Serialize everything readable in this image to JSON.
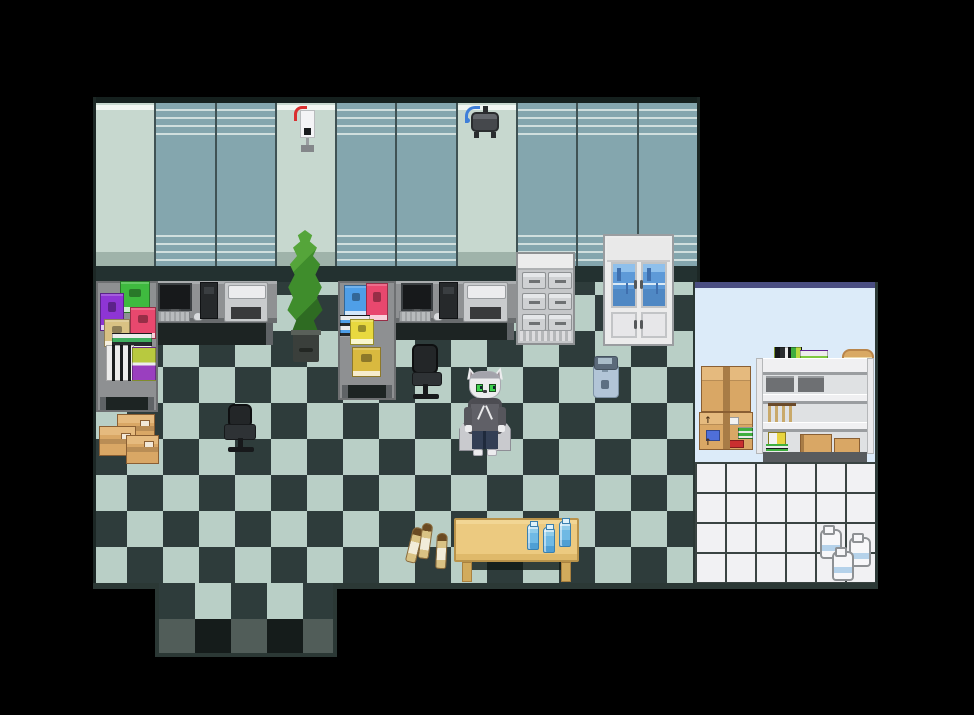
{
  "scene": {
    "label": "pixel-art office room with checkered floor, two computer workstations, storage room and white cat character in hoodie",
    "palette": {
      "bg": "#000000",
      "floorLight": "#b9cfc6",
      "floorDark": "#2e3c3b",
      "exitGray": "#515d59",
      "exitDark": "#151c1b",
      "wallTeal": "#84a6ae",
      "wallPale": "#c7d8cf",
      "wallStripe": "#dde9e6",
      "wallPaleStripe": "#f0f5f1",
      "wallPaleShade": "#9fb3aa",
      "wallDivider": "#3f5254",
      "wallBase": "#233130",
      "wallTopEdge": "#15201e",
      "storageWall": "#dcebf9",
      "storageBorderTop": "#4a4e82",
      "tileWhite": "#f1f1f3",
      "tileGrout": "#3a4442",
      "roomOutline": "#2b3835",
      "deskTop": "#8f9193",
      "deskDark": "#1d2423",
      "deskLegGray": "#5f6366",
      "cardboard": "#d9a765",
      "cardboardFlap": "#e5ba7e",
      "tape": "#a87c46",
      "tableTan": "#ecca80",
      "tableLeg": "#d2ab5c",
      "plantGreen": "#3f8d2c",
      "plantDark": "#2e6b22",
      "potGray": "#3a3f3b",
      "catWhite": "#ececee",
      "catGray": "#a3a3ab",
      "hoodie": "#606067",
      "pants": "#333f55",
      "eyeGreen": "#3fd24f",
      "binBlue": "#b2c5d7",
      "bottleTan": "#d9c284",
      "waterBlue": "#6fb9e4",
      "milkWhite": "#f7f7f9",
      "milkBand": "#b5d2ea"
    },
    "objects": {
      "wall": {
        "label": "office back wall with panels",
        "x": 93,
        "y": 97,
        "w": 607,
        "h": 185
      },
      "floor_main": {
        "label": "checkered office floor",
        "x": 93,
        "y": 270,
        "w": 604,
        "h": 313
      },
      "floor_border_bottom": {
        "label": "floor bottom edge",
        "x": 93,
        "y": 583,
        "w": 604,
        "h": 6
      },
      "floor_exit": {
        "label": "south exit corridor",
        "x": 155,
        "y": 583,
        "w": 182,
        "h": 74
      },
      "storage_room": {
        "label": "storage room with white tile floor",
        "x": 693,
        "y": 282,
        "w": 185,
        "h": 307
      },
      "desk_left": {
        "label": "left workstation desk",
        "x": 98,
        "y": 281,
        "w": 179,
        "h": 64
      },
      "shelf_left": {
        "label": "left corner book shelf",
        "x": 96,
        "y": 281,
        "w": 62,
        "h": 131
      },
      "desk_center": {
        "label": "center workstation desk",
        "x": 338,
        "y": 281,
        "w": 180,
        "h": 59
      },
      "shelf_center": {
        "label": "center corner book shelf",
        "x": 338,
        "y": 281,
        "w": 58,
        "h": 119
      },
      "drawer_unit": {
        "label": "metal drawer cabinet",
        "x": 516,
        "y": 252,
        "w": 59,
        "h": 93
      },
      "display_cabinet": {
        "label": "white cabinet with blue glass doors",
        "x": 603,
        "y": 234,
        "w": 71,
        "h": 112
      },
      "plant": {
        "label": "tall potted plant",
        "x": 285,
        "y": 230,
        "w": 40,
        "h": 132
      },
      "dispenser": {
        "label": "wall sanitizer dispenser",
        "x": 292,
        "y": 106,
        "w": 26,
        "h": 48
      },
      "projector": {
        "label": "wall mounted projector",
        "x": 465,
        "y": 104,
        "w": 38,
        "h": 38
      },
      "chair_left": {
        "label": "black office chair",
        "x": 222,
        "y": 402,
        "w": 38,
        "h": 56
      },
      "chair_center": {
        "label": "black office chair",
        "x": 408,
        "y": 344,
        "w": 36,
        "h": 58
      },
      "cat_character": {
        "label": "white cat character in gray hoodie",
        "x": 461,
        "y": 367,
        "w": 48,
        "h": 92
      },
      "bin": {
        "label": "blue waste bin",
        "x": 591,
        "y": 354,
        "w": 28,
        "h": 44
      },
      "box_large": {
        "label": "cardboard shipping box",
        "x": 640,
        "y": 350,
        "w": 53,
        "h": 54
      },
      "box_small": {
        "label": "cardboard shipping box",
        "x": 646,
        "y": 415,
        "w": 47,
        "h": 40
      },
      "box_cluster": {
        "label": "three small cardboard crates",
        "x": 99,
        "y": 414,
        "w": 58,
        "h": 48
      },
      "box_stack_storage": {
        "label": "stacked shipping boxes",
        "x": 699,
        "y": 366,
        "w": 54,
        "h": 84
      },
      "storage_shelf": {
        "label": "white storage shelving unit",
        "x": 756,
        "y": 350,
        "w": 118,
        "h": 112
      },
      "table": {
        "label": "wooden table",
        "x": 454,
        "y": 518,
        "w": 125,
        "h": 66
      },
      "wine_bottles": {
        "label": "three glass bottles on floor",
        "x": 409,
        "y": 521,
        "w": 44,
        "h": 52
      },
      "water_bottles": {
        "label": "three blue water bottles on table",
        "x": 526,
        "y": 520,
        "w": 48,
        "h": 32
      },
      "milk_jugs": {
        "label": "three white jugs on tiles",
        "x": 819,
        "y": 526,
        "w": 58,
        "h": 56
      }
    }
  }
}
